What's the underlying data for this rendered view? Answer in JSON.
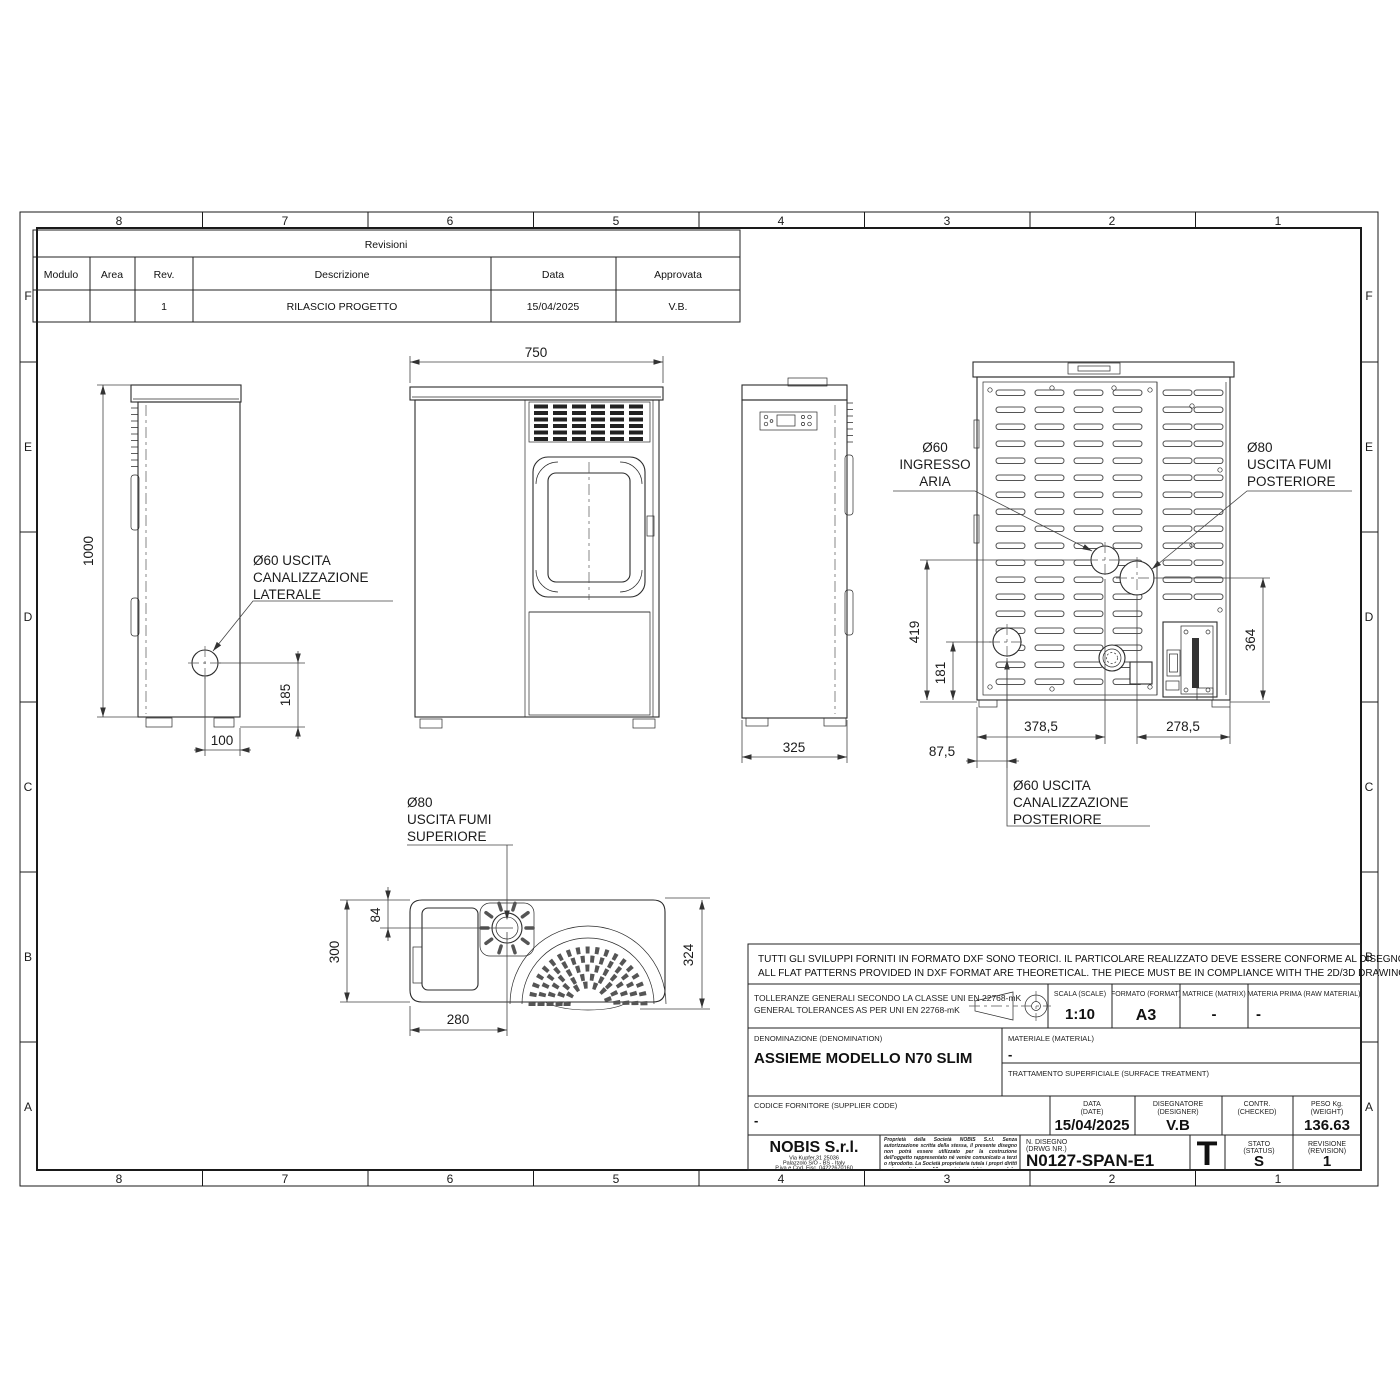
{
  "sheet": {
    "zones_h": [
      "8",
      "7",
      "6",
      "5",
      "4",
      "3",
      "2",
      "1"
    ],
    "zones_v": [
      "F",
      "E",
      "D",
      "C",
      "B",
      "A"
    ],
    "line_color": "#2b2b2b",
    "background": "#ffffff"
  },
  "revisions": {
    "title": "Revisioni",
    "col_modulo": "Modulo",
    "col_area": "Area",
    "col_rev": "Rev.",
    "col_descrizione": "Descrizione",
    "col_data": "Data",
    "col_approvata": "Approvata",
    "row1": {
      "modulo": "",
      "area": "",
      "rev": "1",
      "descrizione": "RILASCIO PROGETTO",
      "data": "15/04/2025",
      "approvata": "V.B."
    }
  },
  "views": {
    "side_left": {
      "label": [
        "Ø60 USCITA",
        "CANALIZZAZIONE",
        "LATERALE"
      ],
      "dim_height": "1000",
      "dim_hole_x": "100",
      "dim_hole_y": "185"
    },
    "front": {
      "dim_width": "750"
    },
    "side_right": {
      "dim_depth": "325"
    },
    "rear": {
      "label_air": [
        "Ø60",
        "INGRESSO",
        "ARIA"
      ],
      "label_flue": [
        "Ø80",
        "USCITA FUMI",
        "POSTERIORE"
      ],
      "label_duct": [
        "Ø60 USCITA",
        "CANALIZZAZIONE",
        "POSTERIORE"
      ],
      "dim_419": "419",
      "dim_181": "181",
      "dim_364": "364",
      "dim_378": "378,5",
      "dim_278": "278,5",
      "dim_87": "87,5"
    },
    "top": {
      "label": [
        "Ø80",
        "USCITA FUMI",
        "SUPERIORE"
      ],
      "dim_300": "300",
      "dim_84": "84",
      "dim_280": "280",
      "dim_324": "324"
    }
  },
  "title_block": {
    "note_it": "TUTTI GLI SVILUPPI FORNITI IN FORMATO DXF SONO TEORICI. IL PARTICOLARE REALIZZATO DEVE ESSERE CONFORME AL DISEGNO 2D/3D",
    "note_en": "ALL FLAT PATTERNS PROVIDED IN DXF FORMAT ARE THEORETICAL. THE PIECE MUST BE IN COMPLIANCE WITH THE 2D/3D DRAWING",
    "tol_it": "TOLLERANZE GENERALI SECONDO LA CLASSE UNI EN 22768-mK",
    "tol_en": "GENERAL TOLERANCES AS PER UNI EN 22768-mK",
    "scale": {
      "label": "SCALA (SCALE)",
      "value": "1:10"
    },
    "format": {
      "label": "FORMATO (FORMAT)",
      "value": "A3"
    },
    "matrix": {
      "label": "MATRICE (MATRIX)",
      "value": "-"
    },
    "raw_material": {
      "label": "MATERIA PRIMA (RAW MATERIAL)",
      "value": "-"
    },
    "denomination": {
      "label": "DENOMINAZIONE  (DENOMINATION)",
      "value": "ASSIEME MODELLO N70 SLIM"
    },
    "material": {
      "label": "MATERIALE  (MATERIAL)",
      "value": "-"
    },
    "surface": {
      "label": "TRATTAMENTO SUPERFICIALE (SURFACE TREATMENT)",
      "value": ""
    },
    "supplier": {
      "label": "CODICE FORNITORE    (SUPPLIER CODE)",
      "value": "-"
    },
    "date": {
      "label": "DATA",
      "label_en": "(DATE)",
      "value": "15/04/2025"
    },
    "designer": {
      "label": "DISEGNATORE",
      "label_en": "(DESIGNER)",
      "value": "V.B"
    },
    "checked": {
      "label": "CONTR.",
      "label_en": "(CHECKED)",
      "value": ""
    },
    "weight": {
      "label": "PESO Kg.",
      "label_en": "(WEIGHT)",
      "value": "136.63"
    },
    "company": {
      "name": "NOBIS S.r.l.",
      "addr1": "Via Kupfer,31 25036",
      "addr2": "Palazzolo S/O - BS - Italy",
      "addr3": "P.iva e Cod. Fisc. 04222670160"
    },
    "legal_it": "Proprietà della Società NOBIS S.r.l. Senza autorizzazione scritta della stessa, il presente disegno non potrà essere utilizzato per la costruzione dell'oggetto rappresentato né venire comunicato a terzi o riprodotto. La Società proprietaria tutela i propri diritti a rigore di legge.",
    "legal_en": "All proprietary rights reserved by NOBIS S.r.l. This drawing shall not be reproduced or in any way utilized for the manufacture of the component or unit herein illustrated and must not be released to other parties without written consent. Any infringement will be legally pursued.",
    "drawing_no": {
      "label": "N. DISEGNO",
      "label_en": "(DRWG NR.)",
      "value": "N0127-SPAN-E1"
    },
    "sheet_marker": "T",
    "status": {
      "label": "STATO",
      "label_en": "(STATUS)",
      "value": "S"
    },
    "revision": {
      "label": "REVISIONE",
      "label_en": "(REVISION)",
      "value": "1"
    }
  }
}
